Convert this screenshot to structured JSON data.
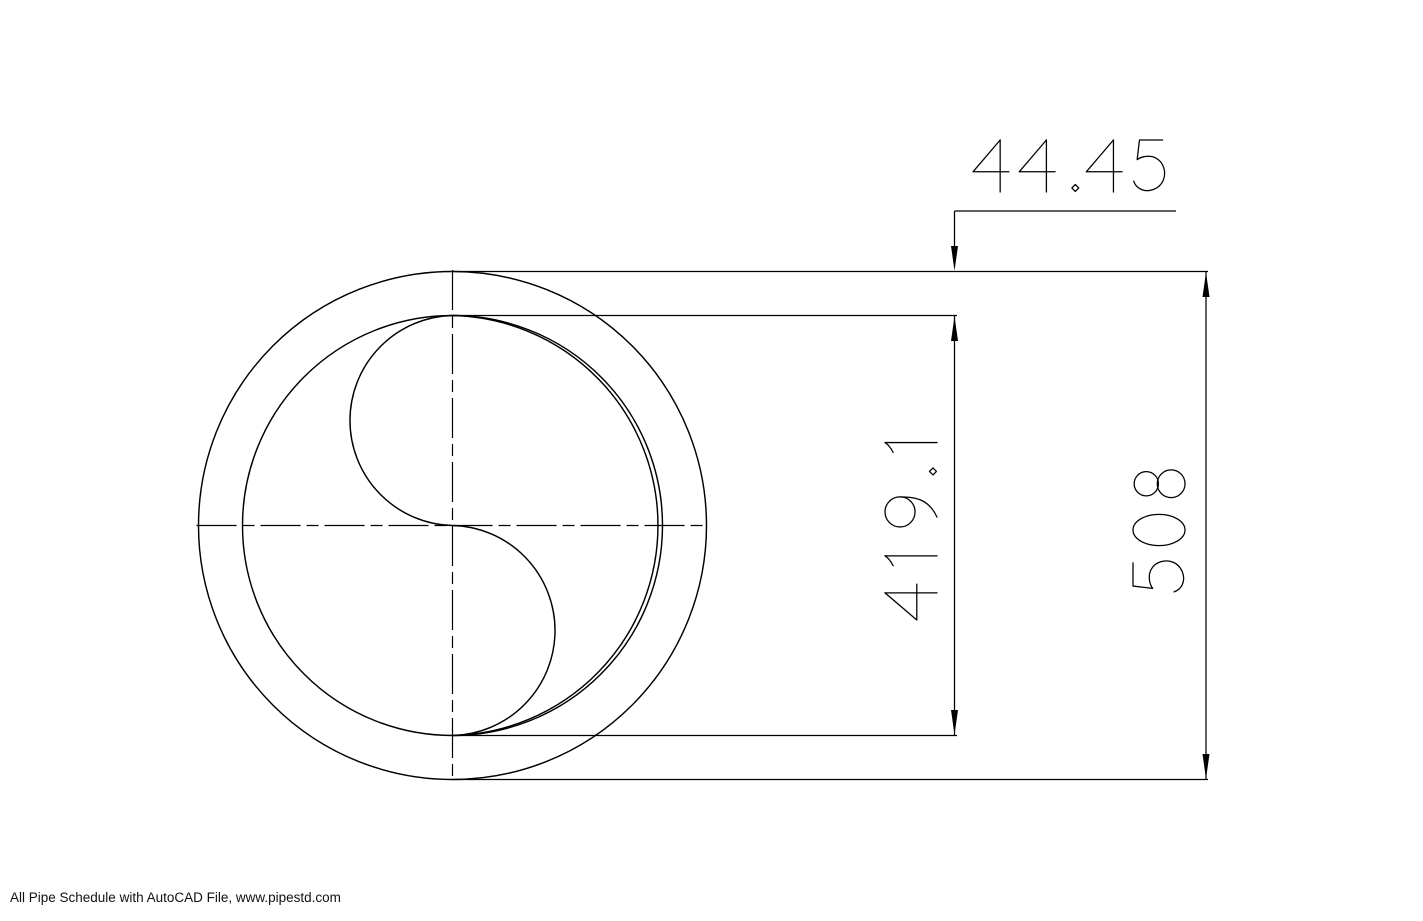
{
  "page": {
    "background_color": "#ffffff",
    "line_color": "#000000"
  },
  "drawing": {
    "type": "pipe-cross-section",
    "dimensions": {
      "wall_thickness": {
        "value": "44.45"
      },
      "inner_diameter": {
        "value": "419.1"
      },
      "outer_diameter": {
        "value": "508"
      }
    }
  },
  "footer": {
    "credit": "All Pipe Schedule with AutoCAD File, www.pipestd.com"
  }
}
